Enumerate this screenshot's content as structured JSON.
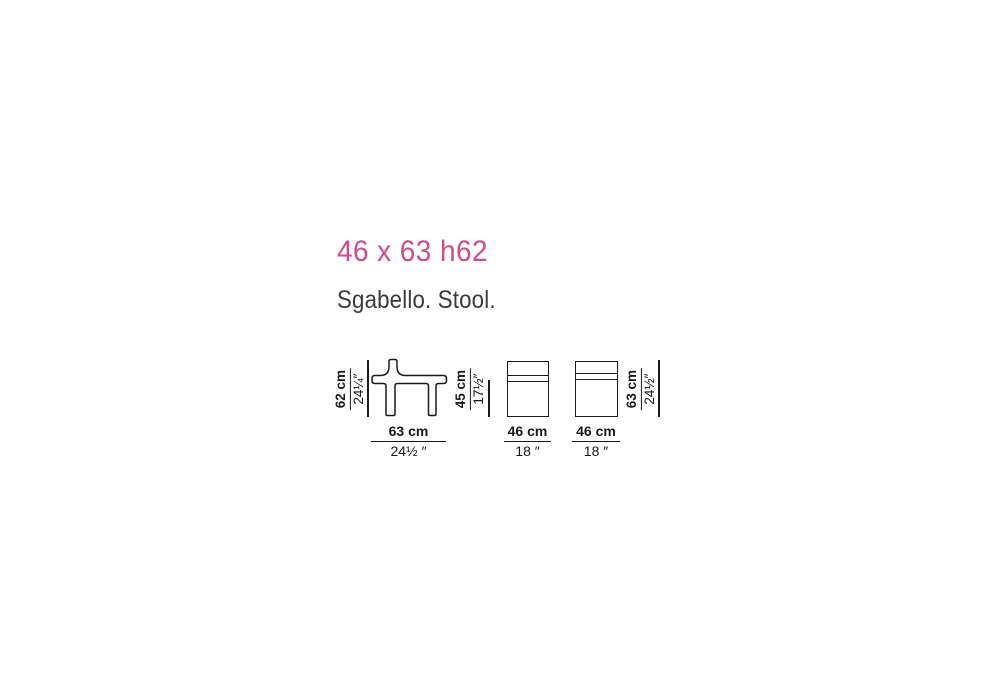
{
  "header": {
    "title": "46 x 63 h62",
    "subtitle": "Sgabello. Stool."
  },
  "colors": {
    "accent_pink": "#d04a8c",
    "subtitle_gray": "#3b3b3b",
    "line_ink": "#1a1a1a"
  },
  "diagrams": [
    {
      "name": "stool-side-profile",
      "height_dim": {
        "metric": "62 cm",
        "imperial": "24¼″"
      },
      "width_dim": {
        "metric": "63 cm",
        "imperial": "24½ ″"
      }
    },
    {
      "name": "stool-front-view",
      "height_dim": {
        "metric": "45 cm",
        "imperial": "17½″"
      },
      "width_dim": {
        "metric": "46 cm",
        "imperial": "18 ″"
      }
    },
    {
      "name": "stool-side-view",
      "height_dim": {
        "metric": "63 cm",
        "imperial": "24½″"
      },
      "width_dim": {
        "metric": "46 cm",
        "imperial": "18 ″"
      }
    }
  ]
}
